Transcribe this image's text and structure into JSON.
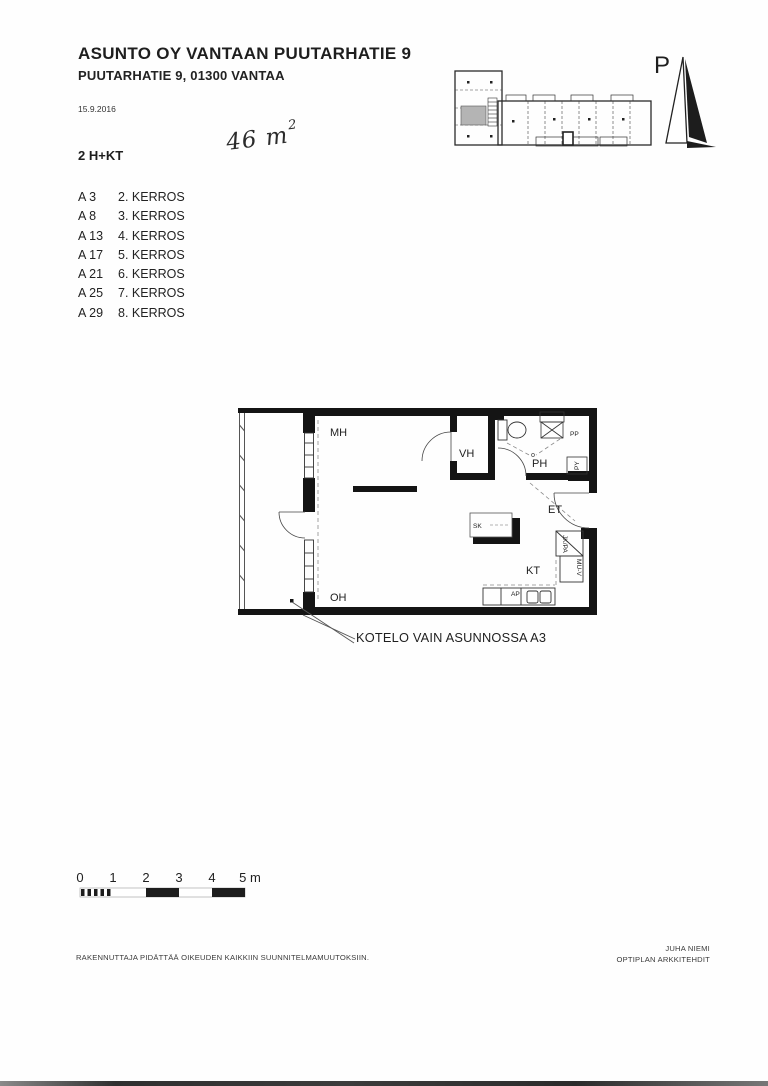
{
  "header": {
    "title": "ASUNTO OY VANTAAN PUUTARHATIE 9",
    "subtitle": "PUUTARHATIE 9, 01300 VANTAA",
    "date": "15.9.2016",
    "apartment_type": "2 H+KT",
    "area_handwritten": "46 m",
    "area_sup": "2"
  },
  "apartments": [
    {
      "unit": "A 3",
      "floor": "2. KERROS"
    },
    {
      "unit": "A 8",
      "floor": "3. KERROS"
    },
    {
      "unit": "A 13",
      "floor": "4. KERROS"
    },
    {
      "unit": "A 17",
      "floor": "5. KERROS"
    },
    {
      "unit": "A 21",
      "floor": "6. KERROS"
    },
    {
      "unit": "A 25",
      "floor": "7. KERROS"
    },
    {
      "unit": "A 29",
      "floor": "8. KERROS"
    }
  ],
  "north_arrow": {
    "label": "P"
  },
  "plan": {
    "rooms": {
      "mh": "MH",
      "vh": "VH",
      "ph": "PH",
      "et": "ET",
      "sk": "SK",
      "kt": "KT",
      "oh": "OH"
    },
    "fixtures": {
      "pp": "PP",
      "py": "PY",
      "jk_pa": "JK/PA",
      "mu_v": "MU-V",
      "ap": "AP"
    },
    "note": "KOTELO VAIN ASUNNOSSA A3"
  },
  "scale_bar": {
    "labels": [
      "0",
      "1",
      "2",
      "3",
      "4",
      "5 m"
    ]
  },
  "footer": {
    "left": "RAKENNUTTAJA PIDÄTTÄÄ OIKEUDEN KAIKKIIN SUUNNITELMAMUUTOKSIIN.",
    "right_line1": "JUHA NIEMI",
    "right_line2": "OPTIPLAN ARKKITEHDIT"
  },
  "colors": {
    "ink": "#1c1c1c",
    "wall": "#141414",
    "shaded_unit": "#b4b4b4"
  }
}
